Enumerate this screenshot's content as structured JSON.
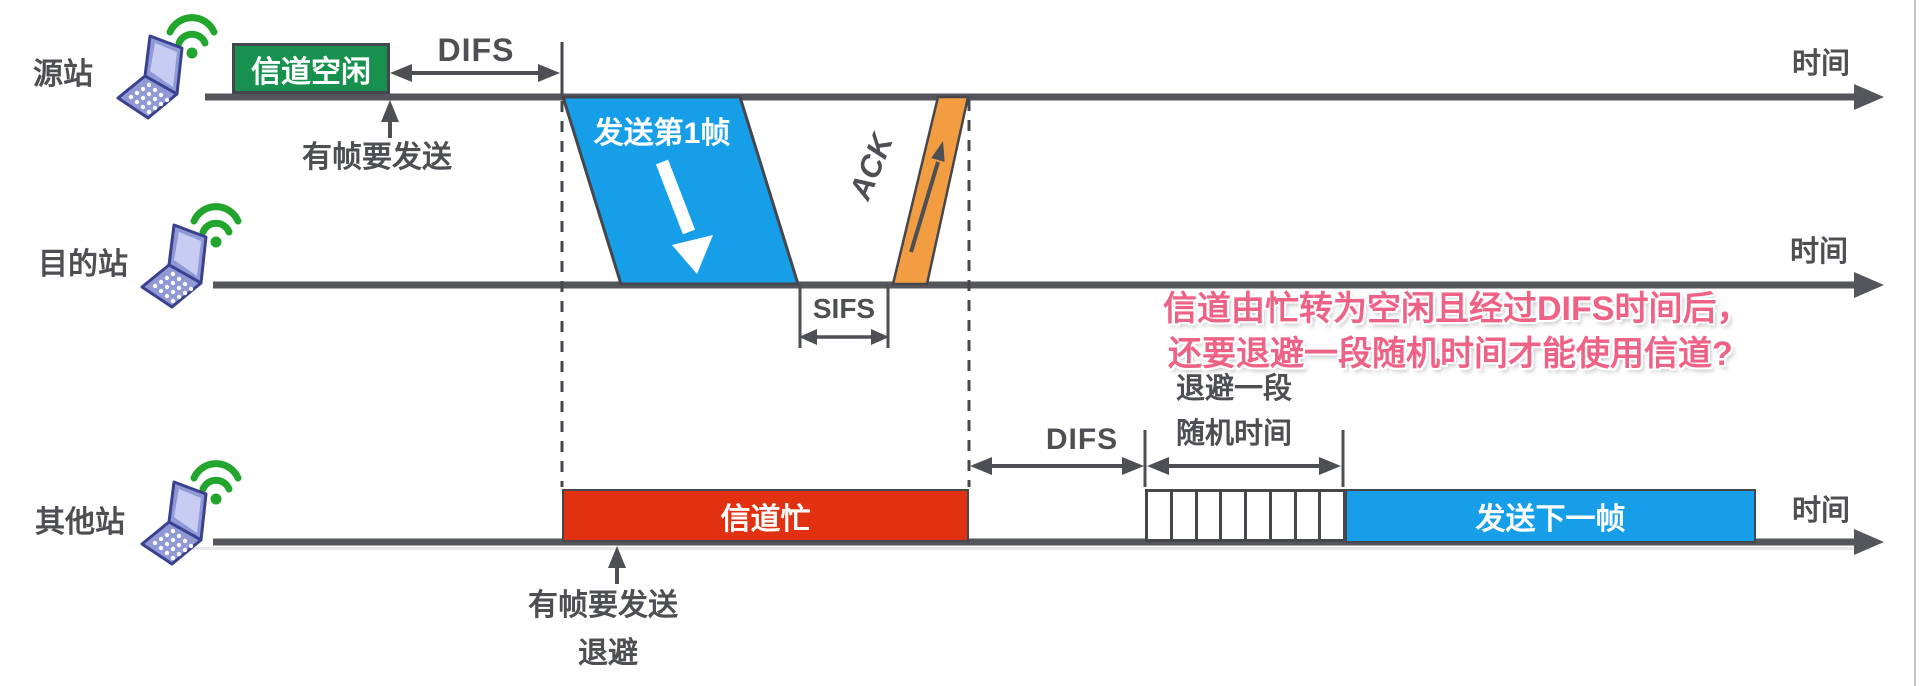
{
  "title": "CSMA/CA DIFS backoff timing diagram",
  "time_axis_label": "时间",
  "stations": [
    {
      "label": "源站"
    },
    {
      "label": "目的站"
    },
    {
      "label": "其他站"
    }
  ],
  "source": {
    "channel_idle_label": "信道空闲",
    "difs_label": "DIFS",
    "frame_arrival_label": "有帧要发送",
    "frame1_label": "发送第1帧",
    "ack_label": "ACK"
  },
  "destination": {
    "sifs_label": "SIFS"
  },
  "others": {
    "channel_busy_label": "信道忙",
    "difs_label": "DIFS",
    "backoff_caption_line1": "退避一段",
    "backoff_caption_line2": "随机时间",
    "slot_count": 8,
    "frame_arrival_label": "有帧要发送",
    "backoff_label": "退避",
    "next_frame_label": "发送下一帧"
  },
  "annotation": {
    "line1": "信道由忙转为空闲且经过DIFS时间后，",
    "line2": "还要退避一段随机时间才能使用信道?"
  },
  "colors": {
    "ink": "#4e4f54",
    "timeline": "#55565c",
    "frame_blue": "#179ee9",
    "ack_orange": "#f39d43",
    "busy_red": "#e23110",
    "idle_green": "#17914d",
    "annotation_pink": "#ee6385",
    "laptop_body": "#8f99d6",
    "wifi_green": "#21a52c"
  }
}
